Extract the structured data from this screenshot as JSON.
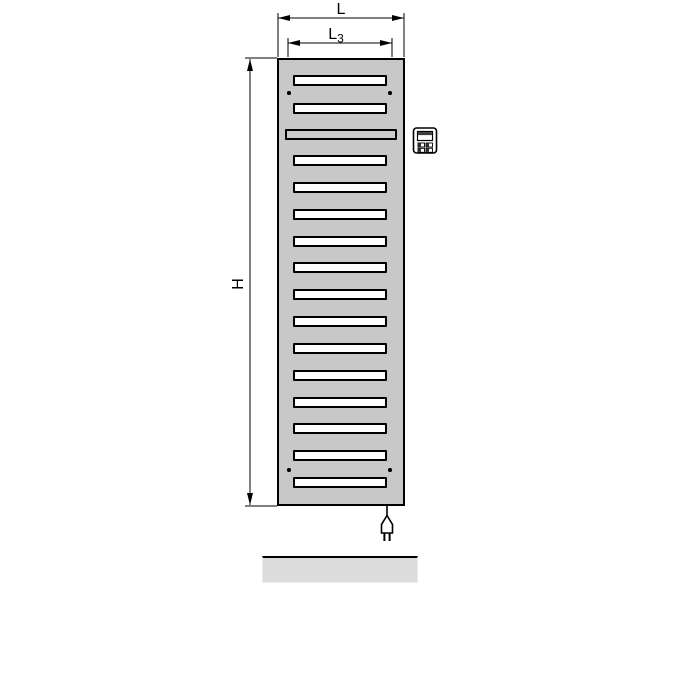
{
  "dimension_labels": {
    "overall_width": "L",
    "connection_width_base": "L",
    "connection_width_subscript": "3",
    "overall_height": "H"
  },
  "radiator": {
    "slot_count": 16,
    "towel_bar_slot_position": 3,
    "mounting_hole_count": 4,
    "body_color": "#c8c8c8",
    "slot_fill": "#ffffff",
    "towel_bar_fill": "#cbcbcb",
    "outline_color": "#000000"
  },
  "floor_strip": {
    "fill": "#dcdcdc"
  },
  "icons": {
    "control_unit": "control-unit-icon",
    "power_plug": "power-plug-icon"
  }
}
